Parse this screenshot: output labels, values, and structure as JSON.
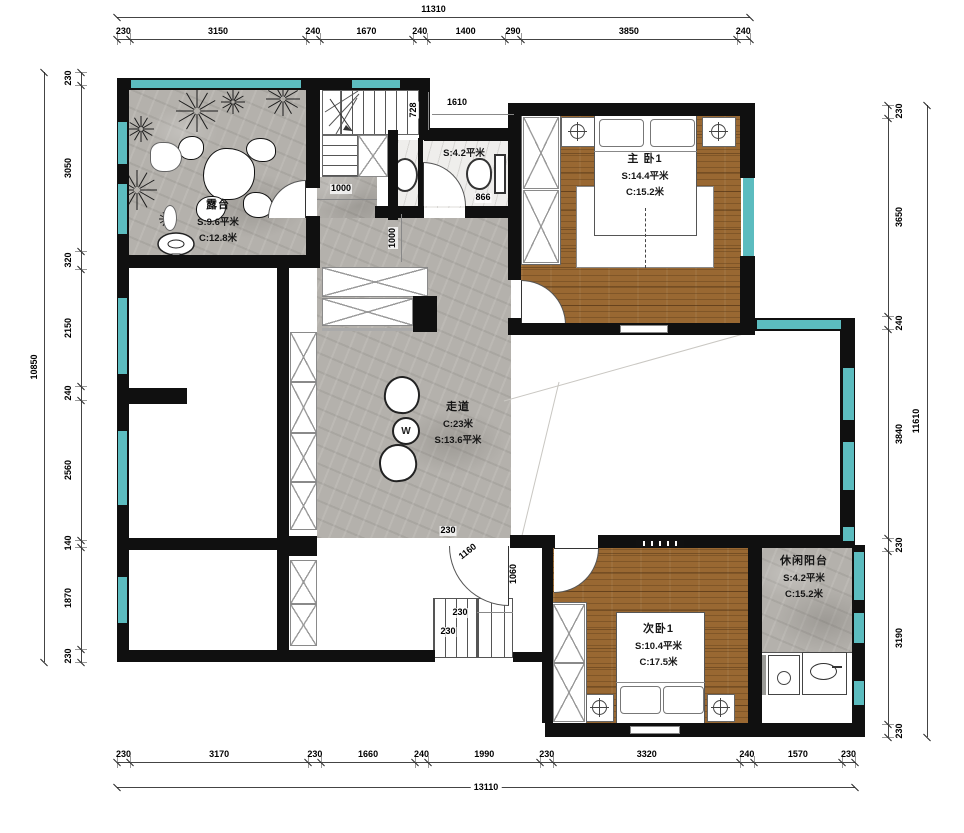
{
  "drawing": {
    "colors": {
      "wall": "#101010",
      "window": "#5cbcbf",
      "wood": "#996832",
      "stone": "#b4b1ac",
      "marble": "#efeeec"
    }
  },
  "dimensions": {
    "top": {
      "total": "11310",
      "segments": [
        "230",
        "3150",
        "240",
        "1670",
        "240",
        "1400",
        "290",
        "3850",
        "240"
      ]
    },
    "bottom": {
      "total": "13110",
      "segments": [
        "230",
        "3170",
        "230",
        "1660",
        "240",
        "1990",
        "230",
        "3320",
        "240",
        "1570",
        "230"
      ]
    },
    "left": {
      "total": "10850",
      "segments": [
        "230",
        "3050",
        "320",
        "2150",
        "240",
        "2560",
        "140",
        "1870",
        "230"
      ]
    },
    "right": {
      "total": "11610",
      "segments": [
        "230",
        "3650",
        "240",
        "3840",
        "230",
        "3190",
        "230"
      ]
    }
  },
  "interior_dimensions": {
    "bath_offset": "728",
    "bath_width": "1610",
    "toilet_width": "866",
    "corridor_width": "1000",
    "corridor_depth": "1000",
    "door_wall": "230",
    "door_swing": "1160",
    "door_leaf": "1060",
    "stair_tread_a": "230",
    "stair_tread_b": "230"
  },
  "rooms": {
    "terrace": {
      "name": "露台",
      "area": "S:9.6平米",
      "perimeter": "C:12.8米"
    },
    "master_bedroom": {
      "name": "主 卧1",
      "area": "S:14.4平米",
      "perimeter": "C:15.2米"
    },
    "corridor": {
      "name": "走道",
      "perimeter": "C:23米",
      "area": "S:13.6平米"
    },
    "bathroom": {
      "area": "S:4.2平米"
    },
    "bedroom2": {
      "name": "次卧1",
      "area": "S:10.4平米",
      "perimeter": "C:17.5米"
    },
    "leisure_balcony": {
      "name": "休闲阳台",
      "area": "S:4.2平米",
      "perimeter": "C:15.2米"
    }
  },
  "furniture_marks": {
    "table": "W"
  }
}
